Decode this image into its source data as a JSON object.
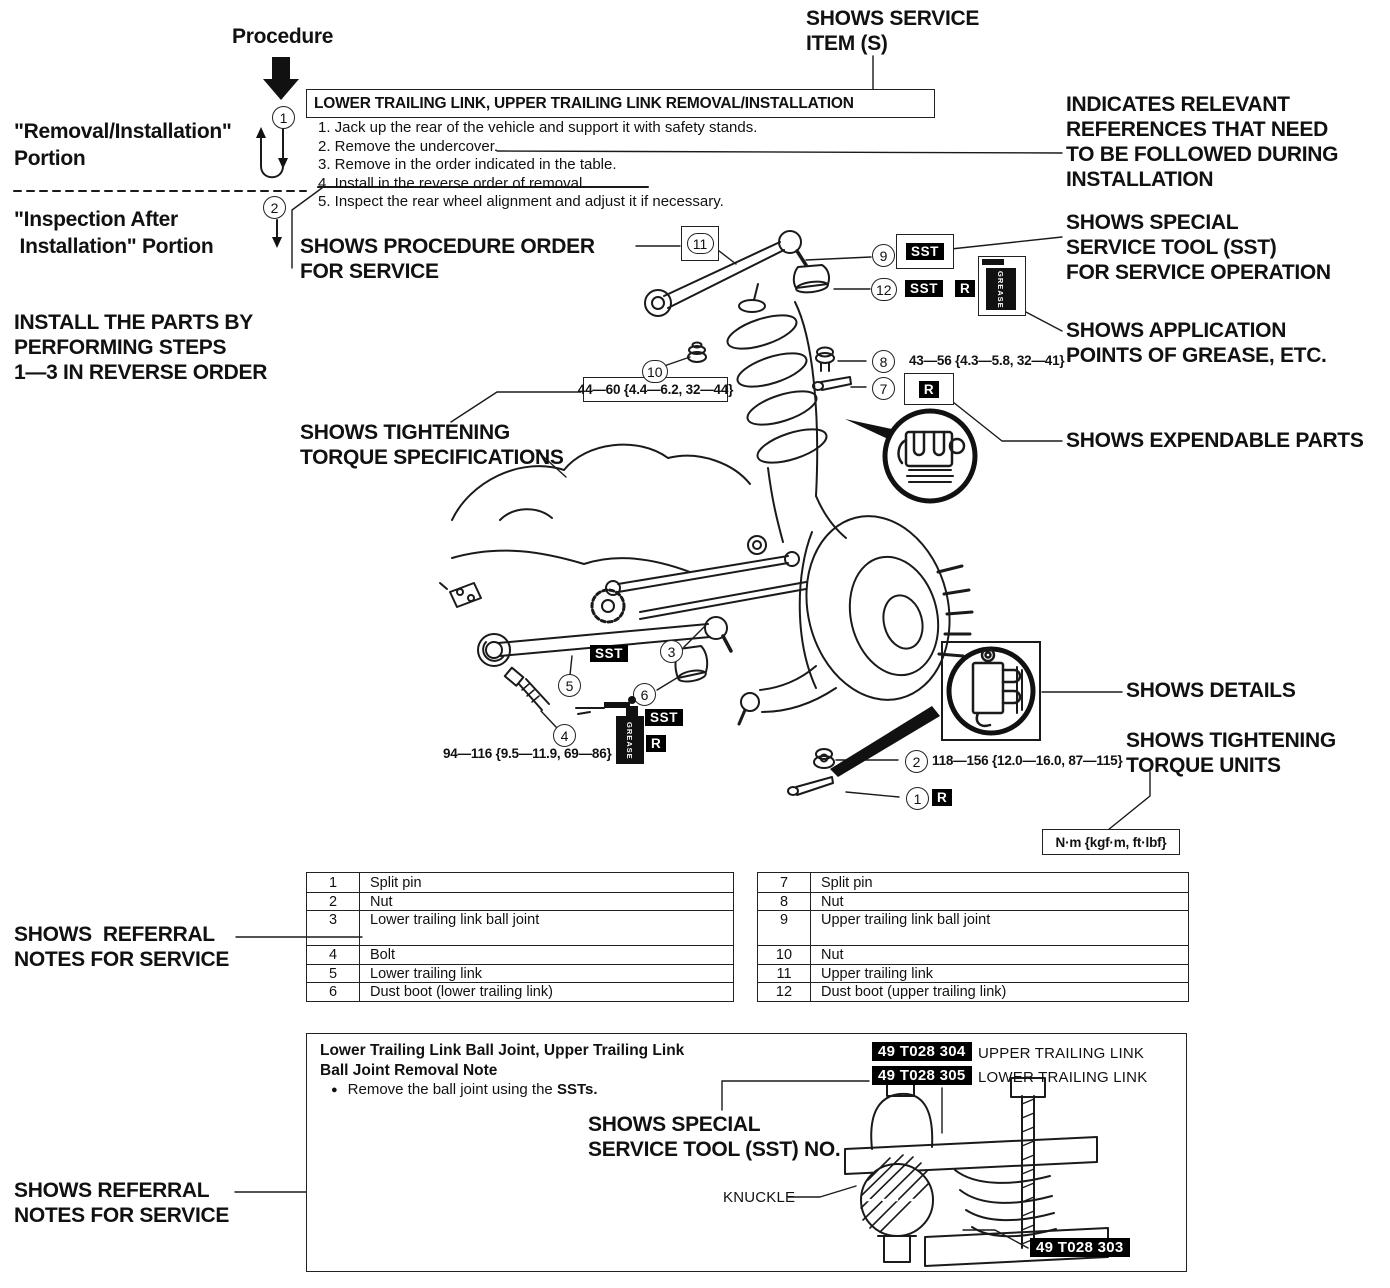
{
  "colors": {
    "ink": "#1a1a1a",
    "badge_bg": "#000000",
    "badge_fg": "#ffffff"
  },
  "labels": {
    "procedure": "Procedure",
    "shows_service_item": "SHOWS SERVICE\nITEM (S)",
    "removal_portion": "\"Removal/Installation\"\nPortion",
    "inspection_portion": "\"Inspection After\n Installation\" Portion",
    "install_reverse": "INSTALL THE PARTS BY\nPERFORMING STEPS\n1—3 IN REVERSE ORDER",
    "shows_procedure_order": "SHOWS PROCEDURE ORDER\nFOR SERVICE",
    "shows_torque_specs": "SHOWS TIGHTENING\nTORQUE SPECIFICATIONS",
    "indicates_references": "INDICATES RELEVANT\nREFERENCES THAT NEED\nTO BE FOLLOWED DURING\nINSTALLATION",
    "shows_sst": "SHOWS SPECIAL\nSERVICE TOOL (SST)\nFOR SERVICE OPERATION",
    "shows_grease_points": "SHOWS APPLICATION\nPOINTS OF GREASE, ETC.",
    "shows_expendable": "SHOWS EXPENDABLE PARTS",
    "shows_details": "SHOWS DETAILS",
    "shows_torque_units": "SHOWS TIGHTENING\nTORQUE UNITS",
    "shows_referral_top": "SHOWS  REFERRAL\nNOTES FOR SERVICE",
    "shows_referral_bottom": "SHOWS REFERRAL\nNOTES FOR SERVICE",
    "shows_sst_no": "SHOWS SPECIAL\nSERVICE TOOL (SST) NO.",
    "knuckle": "KNUCKLE"
  },
  "procedure_box": {
    "title": "LOWER TRAILING LINK, UPPER TRAILING LINK REMOVAL/INSTALLATION",
    "steps": [
      "1. Jack up the rear of the vehicle and support it with safety stands.",
      "2. Remove the undercover.",
      "3. Remove in the order indicated in the table.",
      "4. Install in the reverse order of removal.",
      "5. Inspect the rear wheel alignment and adjust it if necessary."
    ]
  },
  "torque": {
    "upper_link_nut": "44—60 {4.4—6.2, 32—44}",
    "upper_ball_nut": "43—56 {4.3—5.8, 32—41}",
    "lower_link_bolt": "94—116 {9.5—11.9, 69—86}",
    "lower_ball_nut": "118—156 {12.0—16.0, 87—115}",
    "units": "N·m {kgf·m, ft·lbf}"
  },
  "badges": {
    "sst": "SST",
    "r": "R",
    "grease": "GREASE"
  },
  "callouts": {
    "n1": "1",
    "n2": "2",
    "n3": "3",
    "n4": "4",
    "n5": "5",
    "n6": "6",
    "n7": "7",
    "n8": "8",
    "n9": "9",
    "n10": "10",
    "n11": "11",
    "n12": "12"
  },
  "parts_tables": {
    "left": [
      {
        "no": "1",
        "name": "Split pin"
      },
      {
        "no": "2",
        "name": "Nut"
      },
      {
        "no": "3",
        "name": "Lower trailing link ball joint"
      },
      {
        "no": "4",
        "name": "Bolt"
      },
      {
        "no": "5",
        "name": "Lower trailing link"
      },
      {
        "no": "6",
        "name": "Dust boot (lower trailing link)"
      }
    ],
    "right": [
      {
        "no": "7",
        "name": "Split pin"
      },
      {
        "no": "8",
        "name": "Nut"
      },
      {
        "no": "9",
        "name": "Upper trailing link ball joint"
      },
      {
        "no": "10",
        "name": "Nut"
      },
      {
        "no": "11",
        "name": "Upper trailing link"
      },
      {
        "no": "12",
        "name": "Dust boot (upper trailing link)"
      }
    ]
  },
  "note_box": {
    "title": "Lower Trailing Link Ball Joint, Upper Trailing Link\nBall Joint Removal Note",
    "bullet_marker": "●",
    "bullet_text": "Remove the ball joint using the ",
    "bullet_bold": "SSTs.",
    "tools": [
      {
        "code": "49 T028 304",
        "label": "UPPER TRAILING LINK"
      },
      {
        "code": "49 T028 305",
        "label": "LOWER TRAILING LINK"
      }
    ],
    "bottom_tool_code": "49 T028 303"
  }
}
